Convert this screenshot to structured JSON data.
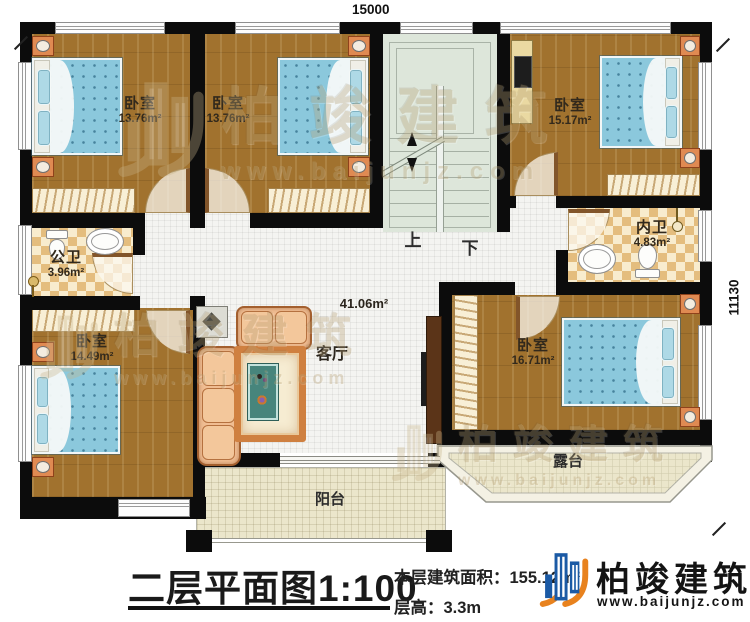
{
  "plan": {
    "dim_top": "15000",
    "dim_right": "11130",
    "stairs": {
      "up": "上",
      "down": "下"
    },
    "rooms": {
      "bedroom_tl": {
        "name": "卧室",
        "area": "13.76m²"
      },
      "bedroom_tm": {
        "name": "卧室",
        "area": "13.76m²"
      },
      "bedroom_tr": {
        "name": "卧室",
        "area": "15.17m²"
      },
      "public_bath": {
        "name": "公卫",
        "area": "3.96m²"
      },
      "private_bath": {
        "name": "内卫",
        "area": "4.83m²"
      },
      "bedroom_bl": {
        "name": "卧室",
        "area": "14.49m²"
      },
      "bedroom_br": {
        "name": "卧室",
        "area": "16.71m²"
      },
      "living": {
        "name": "客厅",
        "area": "41.06m²"
      },
      "balcony": {
        "name": "阳台"
      },
      "terrace": {
        "name": "露台"
      }
    }
  },
  "titleblock": {
    "title": "二层平面图1:100",
    "floor_area": "本层建筑面积：155.12m²",
    "floor_height": "层高：3.3m"
  },
  "brand": {
    "name": "柏竣建筑",
    "website": "www.baijunjz.com",
    "blue": "#1b5aa5",
    "orange": "#e8821e"
  },
  "watermark": {
    "name": "柏竣建筑",
    "website": "www.baijunjz.com"
  }
}
